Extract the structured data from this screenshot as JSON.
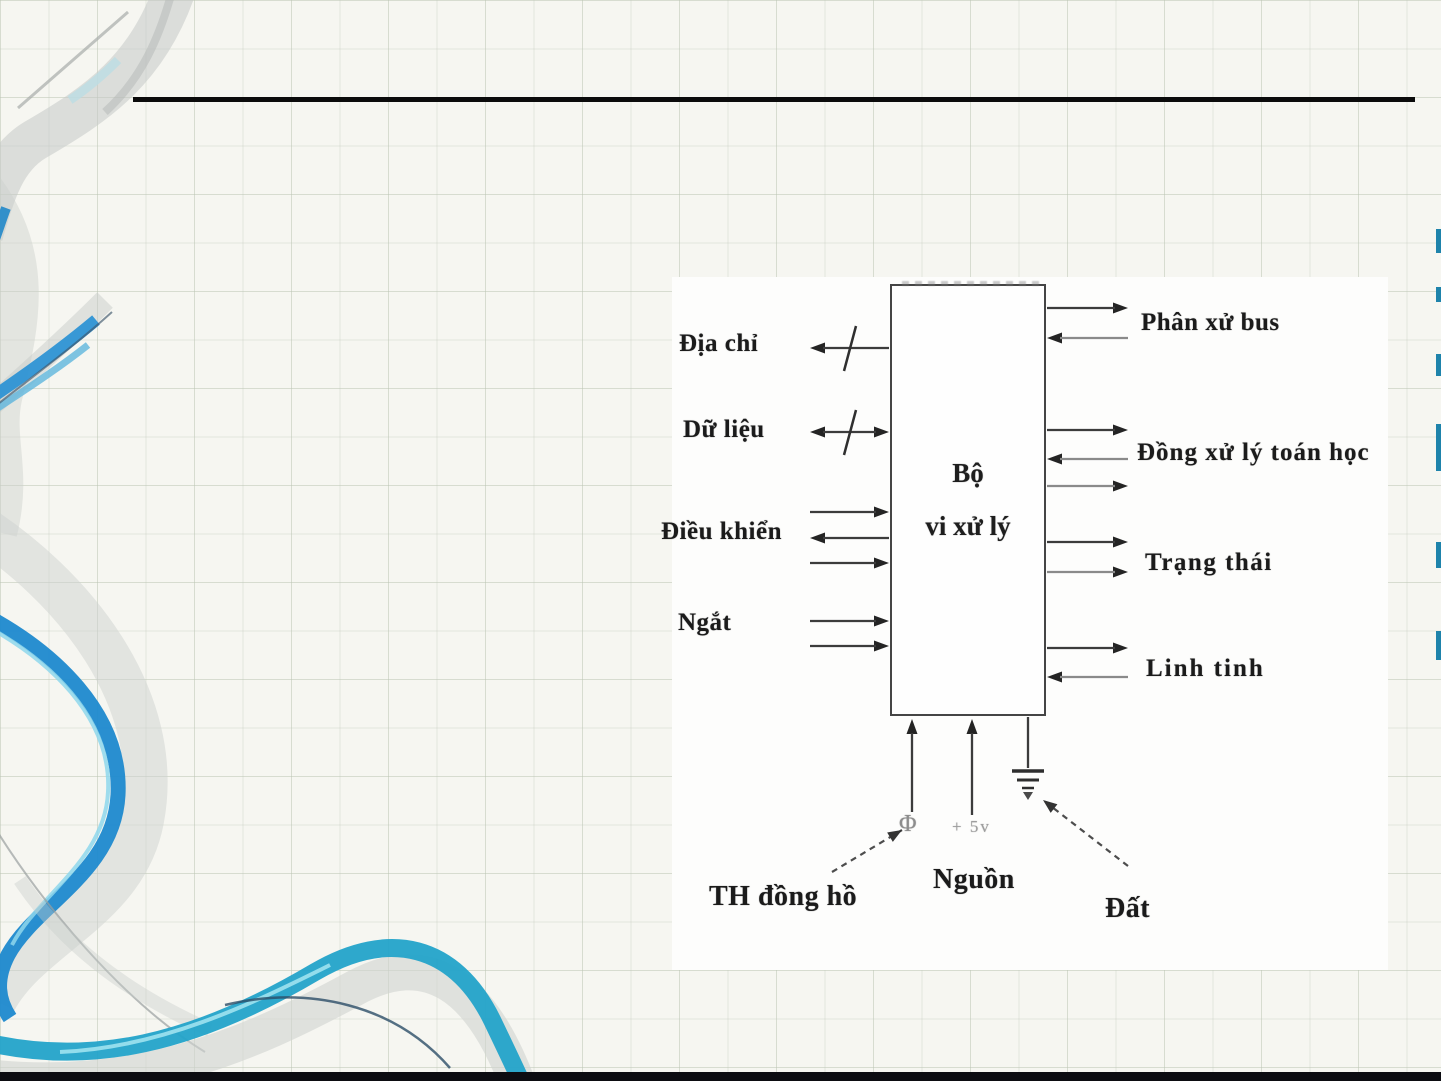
{
  "slide": {
    "paper_color": "#f6f6f1",
    "grid_color": "#dfe3da",
    "title_rule_color": "#0b0b0b",
    "bottom_bar_color": "#0c0c11"
  },
  "diagram": {
    "processor_box": {
      "line1": "Bộ",
      "line2": "vi xử lý"
    },
    "left_buses": [
      {
        "label": "Địa chỉ",
        "slash": true,
        "arrows": [
          "out"
        ]
      },
      {
        "label": "Dữ liệu",
        "slash": true,
        "arrows": [
          "bidir"
        ]
      },
      {
        "label": "Điều khiển",
        "slash": false,
        "arrows": [
          "in",
          "out",
          "in"
        ]
      },
      {
        "label": "Ngắt",
        "slash": false,
        "arrows": [
          "in",
          "in"
        ]
      }
    ],
    "right_buses": [
      {
        "label": "Phân xử bus",
        "arrows": [
          "out",
          "in"
        ]
      },
      {
        "label": "Đồng xử lý toán học",
        "arrows": [
          "out",
          "in",
          "out"
        ]
      },
      {
        "label": "Trạng thái",
        "arrows": [
          "out",
          "out"
        ]
      },
      {
        "label": "Linh tinh",
        "arrows": [
          "out",
          "in"
        ]
      }
    ],
    "bottom_pins": {
      "clock_symbol": "Φ",
      "power_value": "+ 5v",
      "clock_label": "TH đồng hồ",
      "power_label": "Nguồn",
      "ground_label": "Đất"
    }
  },
  "colors": {
    "accent_blue": "#2492cf",
    "teal": "#27a5c9",
    "ribbon_gray": "#cdd1ce",
    "ink": "#1f1f1f"
  }
}
